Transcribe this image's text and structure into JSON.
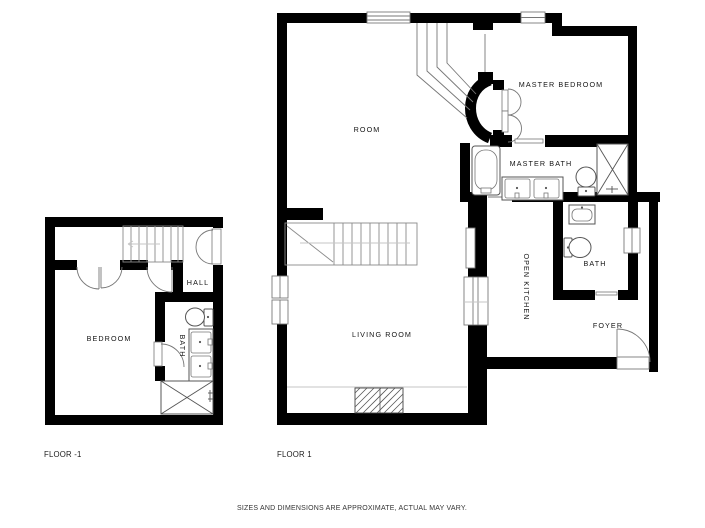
{
  "floor_minus1": {
    "label": "FLOOR -1",
    "rooms": {
      "bedroom": "BEDROOM",
      "hall": "HALL",
      "bath": "BATH"
    }
  },
  "floor_1": {
    "label": "FLOOR 1",
    "rooms": {
      "room": "ROOM",
      "master_bedroom": "MASTER BEDROOM",
      "master_bath": "MASTER BATH",
      "open_kitchen": "OPEN KITCHEN",
      "bath": "BATH",
      "foyer": "FOYER",
      "living_room": "LIVING ROOM"
    }
  },
  "footer": {
    "disclaimer": "SIZES AND DIMENSIONS ARE APPROXIMATE, ACTUAL MAY VARY."
  },
  "colors": {
    "wall": "#000000",
    "fixture_line": "#555555",
    "stair_line": "#8a8a8a"
  }
}
